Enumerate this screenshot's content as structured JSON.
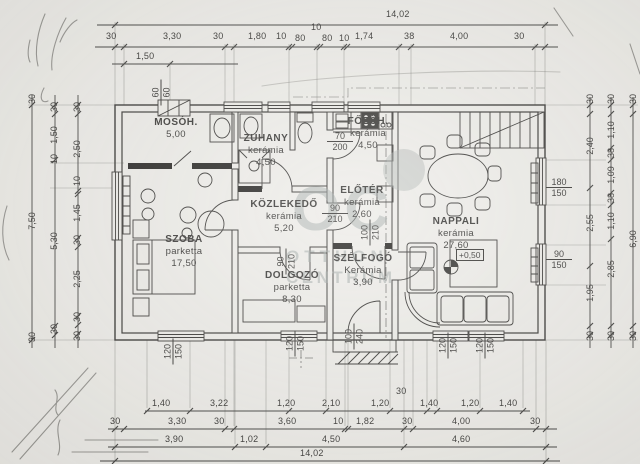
{
  "colors": {
    "paper": "#edece8",
    "ink": "#2e2d2b",
    "watermark": "#9aa3a1"
  },
  "watermark": {
    "logo": "OC",
    "line1": "OTTHON",
    "line2": "CENTRUM"
  },
  "level_mark": "+0,50",
  "rooms": [
    {
      "name": "MOSÓH.",
      "material": "",
      "area": "5,00"
    },
    {
      "name": "ZUHANY",
      "material": "kerámia",
      "area": "4,50"
    },
    {
      "name": "FŐZŐH.",
      "material": "kerámia",
      "area": "4,50"
    },
    {
      "name": "ELŐTÉR",
      "material": "kerámia",
      "area": "2,60"
    },
    {
      "name": "KÖZLEKEDŐ",
      "material": "kerámia",
      "area": "5,20"
    },
    {
      "name": "SZOBA",
      "material": "parketta",
      "area": "17,50"
    },
    {
      "name": "DOLGOZÓ",
      "material": "parketta",
      "area": "8,30"
    },
    {
      "name": "SZÉLFOGÓ",
      "material": "Kerámia",
      "area": "3,90"
    },
    {
      "name": "NAPPALI",
      "material": "kerámia",
      "area": "27,60"
    }
  ],
  "openings": {
    "chimney": {
      "w": "60",
      "h": "60"
    },
    "kitchen_door": {
      "w": "70",
      "h": "200"
    },
    "eloter_door": {
      "w": "90",
      "h": "210"
    },
    "dolgozo_door": {
      "w": "90",
      "h": "210"
    },
    "szelfogo_door": {
      "w": "100",
      "h": "210"
    },
    "entry_door": {
      "w": "100",
      "h": "240"
    },
    "window_szoba": {
      "w": "120",
      "h": "150"
    },
    "window_dolgozo": {
      "w": "120",
      "h": "150"
    },
    "window_nappali_a": {
      "w": "120",
      "h": "150"
    },
    "window_nappali_b": {
      "w": "120",
      "h": "150"
    },
    "window_right_upper": {
      "w": "180",
      "h": "150"
    },
    "window_right_lower": {
      "w": "90",
      "h": "150"
    }
  },
  "dims": {
    "top_total": "14,02",
    "top_row": [
      "30",
      "3,30",
      "30",
      "1,80",
      "10",
      "80",
      "10",
      "80",
      "10",
      "1,74",
      "38",
      "4,00",
      "30"
    ],
    "top_sub": "1,50",
    "bottom_row1": [
      "1,40",
      "3,22",
      "1,20",
      "2,10",
      "1,20",
      "30",
      "1,40",
      "1,20",
      "1,40"
    ],
    "bottom_row2": [
      "30",
      "3,30",
      "30",
      "3,60",
      "10",
      "1,82",
      "30",
      "4,00",
      "30"
    ],
    "bottom_row3": [
      "3,90",
      "1,02",
      "4,50",
      "4,60"
    ],
    "bottom_total": "14,02",
    "left_col1": [
      "30",
      "7,50",
      "30"
    ],
    "left_col2": [
      "30",
      "1,50",
      "10",
      "5,30",
      "30"
    ],
    "left_col3": [
      "30",
      "2,50",
      "10",
      "1,45",
      "30",
      "2,25",
      "30",
      "30"
    ],
    "right_col1": [
      "30",
      "2,40",
      "2,55",
      "1,95",
      "30"
    ],
    "right_col2": [
      "30",
      "1,10",
      "38",
      "1,09",
      "38",
      "1,10",
      "2,85",
      "30"
    ],
    "right_col3": [
      "30",
      "6,90",
      "30"
    ]
  }
}
